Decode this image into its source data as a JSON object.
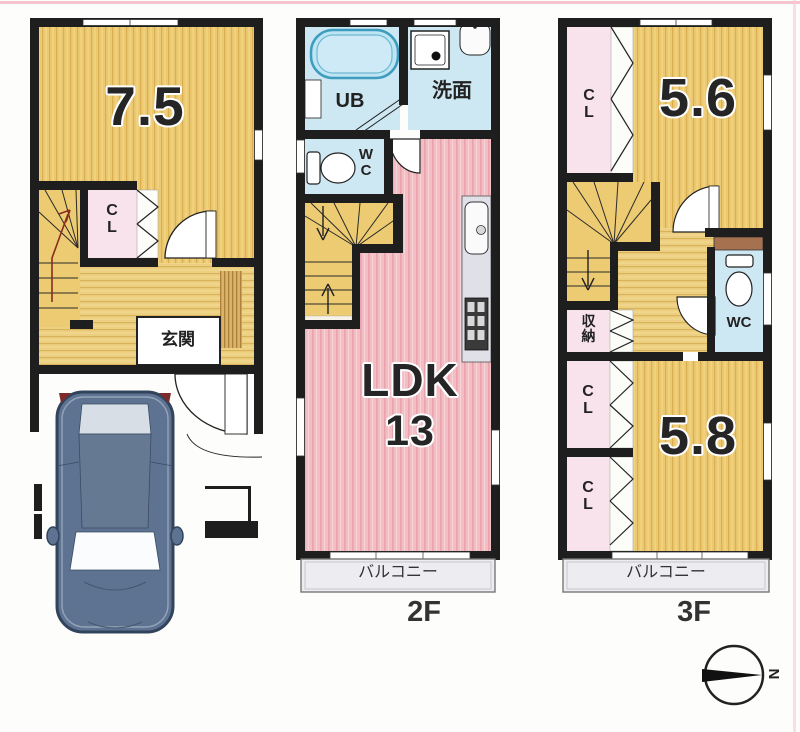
{
  "floor1": {
    "room_size": "7.5",
    "closet": "CL",
    "entrance": "玄関"
  },
  "floor2": {
    "bath": "UB",
    "washroom": "洗面",
    "toilet": "WC",
    "living": "LDK",
    "living_size": "13",
    "balcony": "バルコニー",
    "floor_label": "2F"
  },
  "floor3": {
    "room_a_size": "5.6",
    "room_b_size": "5.8",
    "closet_top": "CL",
    "closet_mid": "CL",
    "closet_bottom": "CL",
    "storage": "収納",
    "toilet": "WC",
    "balcony": "バルコニー",
    "floor_label": "3F"
  },
  "compass": {
    "north": "N"
  },
  "colors": {
    "wall": "#1e1e1e",
    "wood_floor": "#ecc971",
    "hall_floor": "#eccf80",
    "ldk_pink": "#f3bdc4",
    "closet_pink": "#f8e3ec",
    "wet_blue": "#cde8f2",
    "tub_blue": "#bee5f2",
    "balcony_gray": "#ededf1",
    "shelf_brown": "#a5714f",
    "car_blue": "#5d7391",
    "edge_pink": "#f3bac5"
  }
}
